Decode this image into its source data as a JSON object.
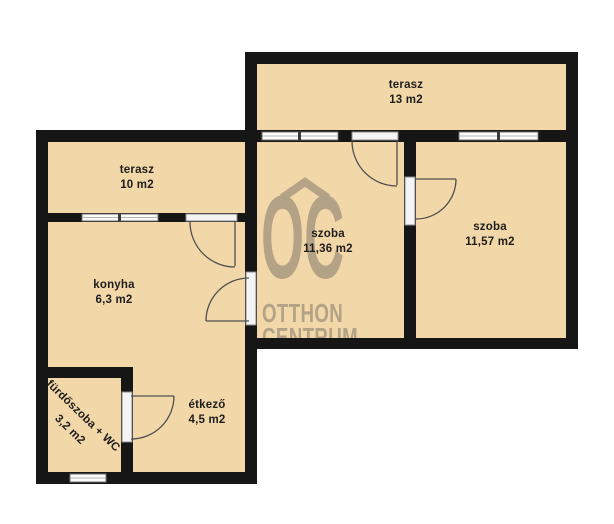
{
  "plan_title": "apartment floor plan",
  "watermark": {
    "logo": "OC",
    "brand_line1": "OTTHON",
    "brand_line2": "CENTRUM"
  },
  "rooms": [
    {
      "id": "terasz-13",
      "name": "terasz",
      "area": "13 m2"
    },
    {
      "id": "terasz-10",
      "name": "terasz",
      "area": "10 m2"
    },
    {
      "id": "szoba-11-36",
      "name": "szoba",
      "area": "11,36 m2"
    },
    {
      "id": "szoba-11-57",
      "name": "szoba",
      "area": "11,57 m2"
    },
    {
      "id": "konyha",
      "name": "konyha",
      "area": "6,3 m2"
    },
    {
      "id": "etkezo",
      "name": "étkező",
      "area": "4,5 m2"
    },
    {
      "id": "furdoszoba-wc",
      "name": "fürdőszoba + WC",
      "area": "3,2 m2"
    }
  ],
  "colors": {
    "floor": "#f2d7a9",
    "wall": "#161616",
    "watermark": "#b0a085",
    "background": "#ffffff",
    "label_text": "#1d1d1d"
  }
}
